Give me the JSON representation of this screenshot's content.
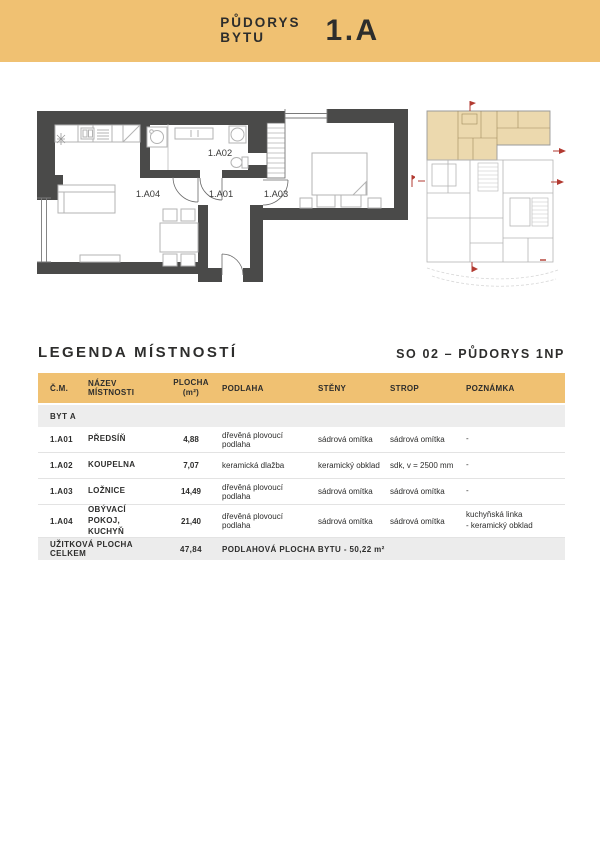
{
  "header": {
    "title_line1": "PŮDORYS",
    "title_line2": "BYTU",
    "unit": "1.A"
  },
  "main_plan": {
    "rooms": [
      {
        "id": "1.A02"
      },
      {
        "id": "1.A04"
      },
      {
        "id": "1.A01"
      },
      {
        "id": "1.A03"
      }
    ]
  },
  "legend": {
    "title": "LEGENDA MÍSTNOSTÍ",
    "subtitle": "SO 02 – PŮDORYS 1NP"
  },
  "table": {
    "columns": [
      "Č.M.",
      "NÁZEV MÍSTNOSTI",
      "PLOCHA",
      "PODLAHA",
      "STĚNY",
      "STROP",
      "POZNÁMKA"
    ],
    "area_unit": "(m²)",
    "section": "BYT A",
    "rows": [
      {
        "cm": "1.A01",
        "name": "PŘEDSÍŇ",
        "area": "4,88",
        "floor": "dřevěná plovoucí podlaha",
        "walls": "sádrová omítka",
        "ceiling": "sádrová omítka",
        "note": "-"
      },
      {
        "cm": "1.A02",
        "name": "KOUPELNA",
        "area": "7,07",
        "floor": "keramická dlažba",
        "walls": "keramický obklad",
        "ceiling": "sdk, v = 2500 mm",
        "note": "-"
      },
      {
        "cm": "1.A03",
        "name": "LOŽNICE",
        "area": "14,49",
        "floor": "dřevěná plovoucí podlaha",
        "walls": "sádrová omítka",
        "ceiling": "sádrová omítka",
        "note": "-"
      },
      {
        "cm": "1.A04",
        "name": "OBÝVACÍ POKOJ, KUCHYŇ",
        "area": "21,40",
        "floor": "dřevěná plovoucí podlaha",
        "walls": "sádrová omítka",
        "ceiling": "sádrová omítka",
        "note": "kuchyňská linka\n- keramický obklad"
      }
    ],
    "footer": {
      "label": "UŽITKOVÁ PLOCHA CELKEM",
      "area": "47,84",
      "note": "PODLAHOVÁ PLOCHA BYTU - 50,22 m²"
    }
  },
  "colors": {
    "gold": "#f0c172",
    "dark": "#2d2d2c",
    "wall": "#4a4a49",
    "beige": "#ecd9ae",
    "red": "#b23a31"
  }
}
